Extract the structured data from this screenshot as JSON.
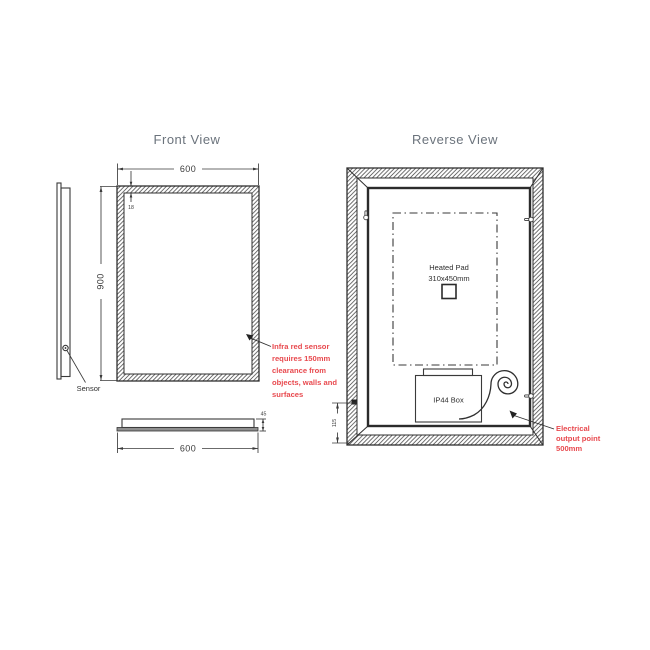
{
  "colors": {
    "title": "#6b737c",
    "red_accent": "#e8494e",
    "line": "#3a3a3a"
  },
  "titles": {
    "front": "Front View",
    "reverse": "Reverse View"
  },
  "front_view": {
    "width_dim": "600",
    "height_dim": "900",
    "frame_thickness_dim": "18",
    "sensor_label": "Sensor"
  },
  "bottom_profile": {
    "width_dim": "600",
    "depth_dim": "45"
  },
  "reverse_view": {
    "heated_pad_title": "Heated Pad",
    "heated_pad_size": "310x450mm",
    "junction_box_label": "IP44 Box",
    "cable_height_dim": "115"
  },
  "notes": {
    "sensor_clearance_lines": [
      "Infra red sensor",
      "requires 150mm",
      "clearance from",
      "objects, walls and",
      "surfaces"
    ],
    "electrical_output_lines": [
      "Electrical",
      "output point",
      "500mm"
    ]
  }
}
